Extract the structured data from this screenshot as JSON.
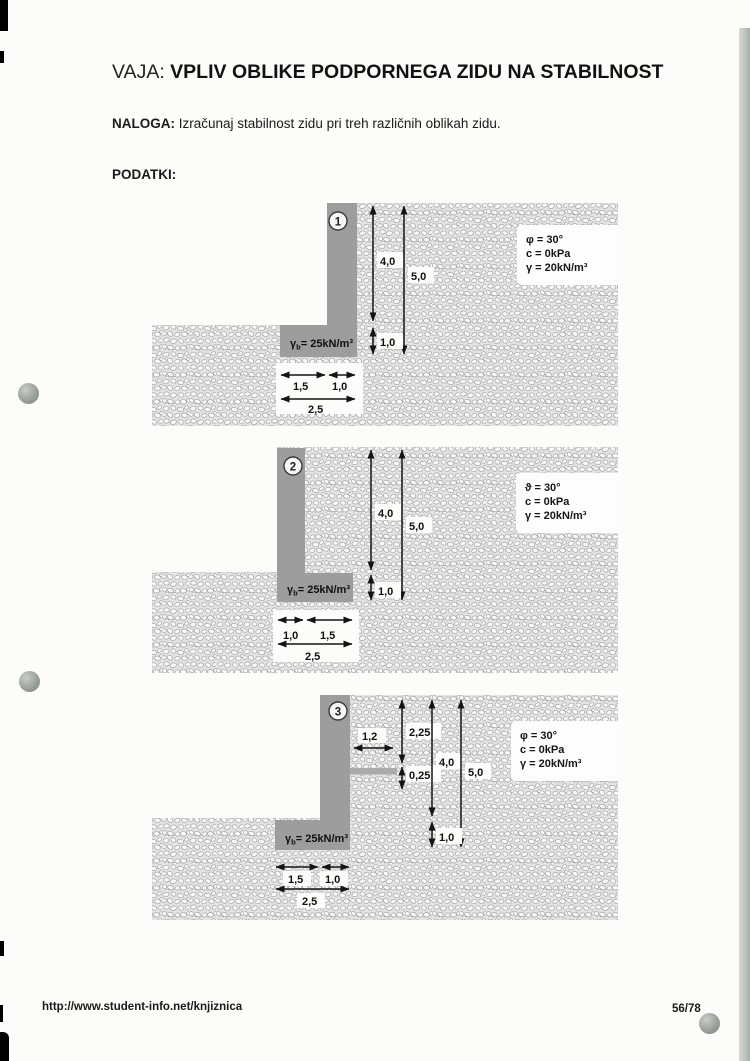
{
  "page": {
    "title_prefix": "VAJA: ",
    "title": "VPLIV OBLIKE PODPORNEGA ZIDU NA STABILNOST",
    "task_label": "NALOGA: ",
    "task_text": "Izračunaj stabilnost zidu pri treh različnih oblikah zidu.",
    "data_label": "PODATKI:",
    "footer_url": "http://www.student-info.net/knjiznica",
    "footer_page": "56/78"
  },
  "colors": {
    "wall_gray": "#9d9d9d",
    "shelf_gray": "#ababab",
    "soil_base": "#e3e3e3"
  },
  "diagrams": [
    {
      "number": "1",
      "wall_unit_weight": {
        "symbol": "γ",
        "subscript": "b",
        "value": "= 25kN/m³"
      },
      "soil_params": [
        "φ = 30°",
        "c = 0kPa",
        "γ = 20kN/m³"
      ],
      "dims": {
        "h_upper": "4,0",
        "h_total": "5,0",
        "h_base": "1,0",
        "w_heel": "1,5",
        "w_stem": "1,0",
        "w_base": "2,5"
      }
    },
    {
      "number": "2",
      "wall_unit_weight": {
        "symbol": "γ",
        "subscript": "b",
        "value": "= 25kN/m³"
      },
      "soil_params": [
        "ϑ = 30°",
        "c = 0kPa",
        "γ = 20kN/m³"
      ],
      "dims": {
        "h_upper": "4,0",
        "h_total": "5,0",
        "h_base": "1,0",
        "w_stem": "1,0",
        "w_toe": "1,5",
        "w_base": "2,5"
      }
    },
    {
      "number": "3",
      "wall_unit_weight": {
        "symbol": "γ",
        "subscript": "b",
        "value": "= 25kN/m³"
      },
      "soil_params": [
        "φ = 30°",
        "c = 0kPa",
        "γ = 20kN/m³"
      ],
      "dims": {
        "shelf_len": "1,2",
        "h_shelf_top": "2,25",
        "shelf_thk": "0,25",
        "h_upper": "4,0",
        "h_total": "5,0",
        "h_base": "1,0",
        "w_heel": "1,5",
        "w_stem": "1,0",
        "w_base": "2,5"
      }
    }
  ]
}
